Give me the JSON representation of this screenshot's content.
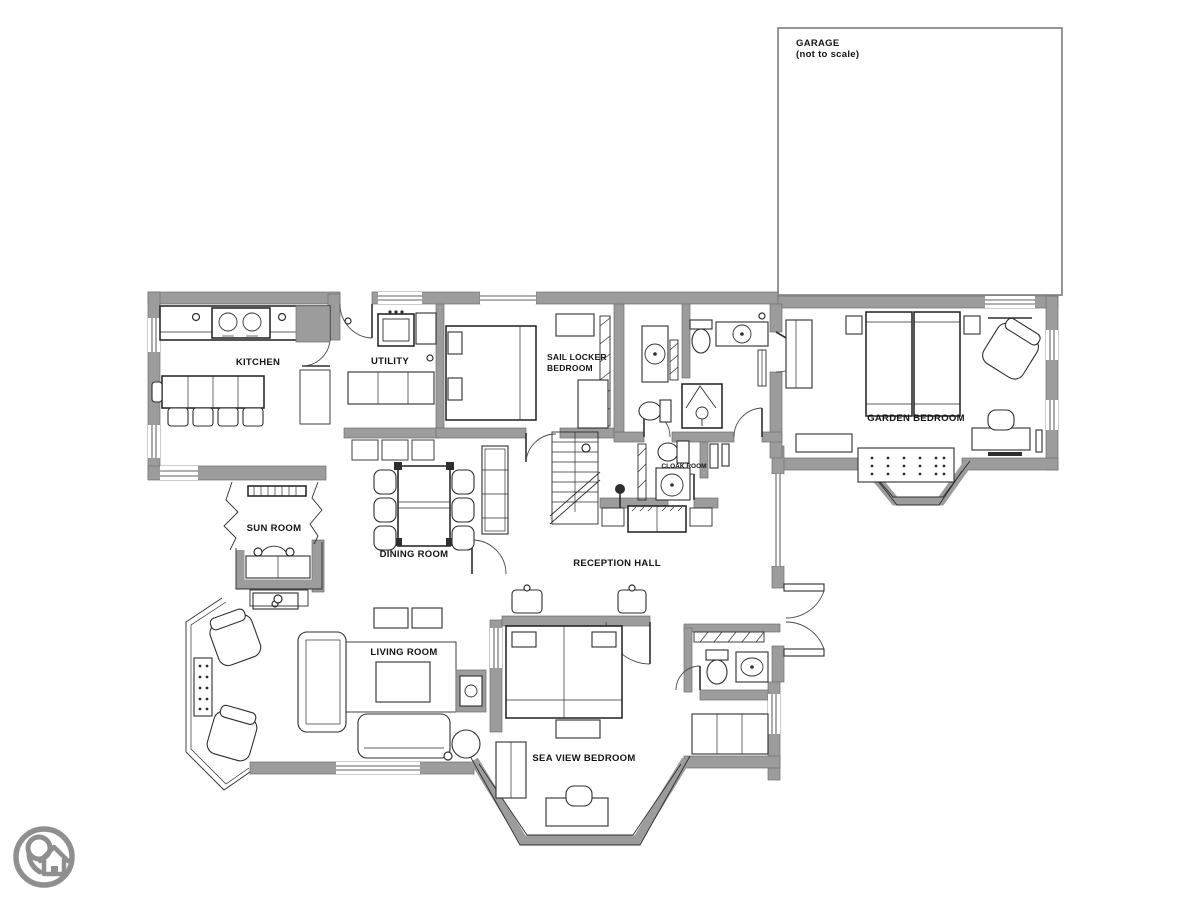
{
  "garage": {
    "name": "GARAGE",
    "note": "(not to scale)"
  },
  "rooms": {
    "kitchen": {
      "label": "KITCHEN"
    },
    "utility": {
      "label": "UTILITY"
    },
    "sail_locker": {
      "label_line1": "SAIL LOCKER",
      "label_line2": "BEDROOM"
    },
    "garden_bedroom": {
      "label": "GARDEN BEDROOM"
    },
    "sun_room": {
      "label": "SUN ROOM"
    },
    "dining_room": {
      "label": "DINING ROOM"
    },
    "cloak_room": {
      "label": "CLOAK ROOM"
    },
    "reception_hall": {
      "label": "RECEPTION HALL"
    },
    "living_room": {
      "label": "LIVING ROOM"
    },
    "sea_view_bedroom": {
      "label": "SEA VIEW BEDROOM"
    }
  },
  "colors": {
    "background": "#ffffff",
    "wall_fill": "#9c9c9c",
    "line": "#2e2e2e",
    "logo": "#8f8f8f"
  }
}
